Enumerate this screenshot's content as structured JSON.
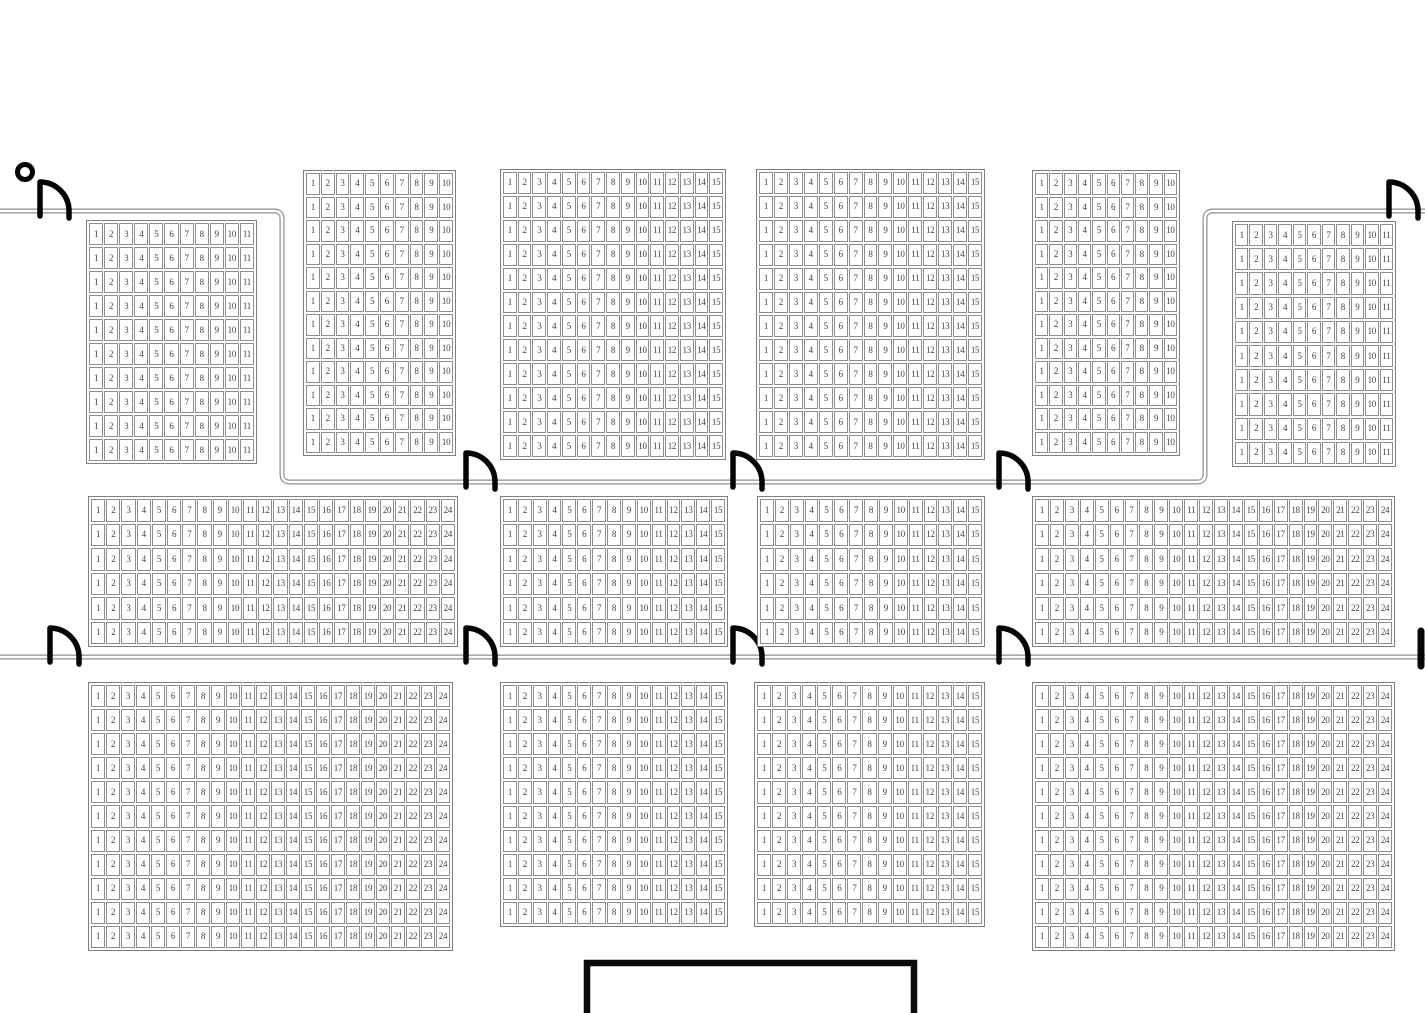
{
  "canvas": {
    "width": 1425,
    "height": 1013,
    "background": "#ffffff"
  },
  "colors": {
    "cell_border": "#8d8d8d",
    "block_border": "#7e7e7e",
    "seat_number_text": "#3f3f3f",
    "wall_line": "#8e8e8e",
    "wall_core": "#ffffff",
    "door_symbol": "#050505",
    "stage_border": "#0a0a0a"
  },
  "numbering_rule": "every row of every seating block is numbered left to right starting at 1 up to the block's column count",
  "seating_blocks": [
    {
      "id": "top-left",
      "x": 86,
      "y": 220,
      "w": 171,
      "h": 244,
      "cols": 11,
      "rows": 10
    },
    {
      "id": "top-2",
      "x": 303,
      "y": 170,
      "w": 153,
      "h": 286,
      "cols": 10,
      "rows": 12
    },
    {
      "id": "top-3",
      "x": 500,
      "y": 169,
      "w": 226,
      "h": 291,
      "cols": 15,
      "rows": 12
    },
    {
      "id": "top-4",
      "x": 756,
      "y": 169,
      "w": 229,
      "h": 291,
      "cols": 15,
      "rows": 12
    },
    {
      "id": "top-5",
      "x": 1032,
      "y": 170,
      "w": 148,
      "h": 286,
      "cols": 10,
      "rows": 12
    },
    {
      "id": "top-right",
      "x": 1232,
      "y": 221,
      "w": 164,
      "h": 246,
      "cols": 11,
      "rows": 10
    },
    {
      "id": "middle-1",
      "x": 88,
      "y": 496,
      "w": 370,
      "h": 151,
      "cols": 24,
      "rows": 6
    },
    {
      "id": "middle-2",
      "x": 500,
      "y": 496,
      "w": 228,
      "h": 151,
      "cols": 15,
      "rows": 6
    },
    {
      "id": "middle-3",
      "x": 757,
      "y": 496,
      "w": 228,
      "h": 151,
      "cols": 15,
      "rows": 6
    },
    {
      "id": "middle-4",
      "x": 1032,
      "y": 496,
      "w": 363,
      "h": 151,
      "cols": 24,
      "rows": 6
    },
    {
      "id": "bottom-1",
      "x": 88,
      "y": 682,
      "w": 365,
      "h": 269,
      "cols": 24,
      "rows": 11
    },
    {
      "id": "bottom-2",
      "x": 500,
      "y": 682,
      "w": 228,
      "h": 245,
      "cols": 15,
      "rows": 10
    },
    {
      "id": "bottom-3",
      "x": 754,
      "y": 682,
      "w": 231,
      "h": 245,
      "cols": 15,
      "rows": 10
    },
    {
      "id": "bottom-4",
      "x": 1032,
      "y": 682,
      "w": 363,
      "h": 269,
      "cols": 24,
      "rows": 11
    }
  ],
  "walls": [
    {
      "id": "perimeter-upper-wall",
      "path": "M0,211 H274 Q282,211 282,219 V474 Q282,482 290,482 H1197 Q1205,482 1205,474 V219 Q1205,211 1213,211 H1425"
    },
    {
      "id": "middle-dividing-wall",
      "path": "M0,657 H1425"
    }
  ],
  "doors": [
    {
      "id": "door-top-left-entrance",
      "stem_x": 40,
      "wall_y": 211
    },
    {
      "id": "door-top-right-entrance",
      "stem_x": 1389,
      "wall_y": 211
    },
    {
      "id": "door-upper-wall-1",
      "stem_x": 466,
      "wall_y": 482
    },
    {
      "id": "door-upper-wall-2",
      "stem_x": 733,
      "wall_y": 482
    },
    {
      "id": "door-upper-wall-3",
      "stem_x": 999,
      "wall_y": 482
    },
    {
      "id": "door-middle-wall-left",
      "stem_x": 50,
      "wall_y": 657
    },
    {
      "id": "door-middle-wall-1",
      "stem_x": 466,
      "wall_y": 657
    },
    {
      "id": "door-middle-wall-2",
      "stem_x": 733,
      "wall_y": 657
    },
    {
      "id": "door-middle-wall-3",
      "stem_x": 999,
      "wall_y": 657
    }
  ],
  "door_stub_right_edge": {
    "x": 1421,
    "y1": 631,
    "y2": 666
  },
  "entrance_marker_circle": {
    "cx": 25,
    "cy": 172,
    "r": 7.5
  },
  "stage": {
    "x": 587,
    "y": 963,
    "w": 327,
    "h": 70
  }
}
